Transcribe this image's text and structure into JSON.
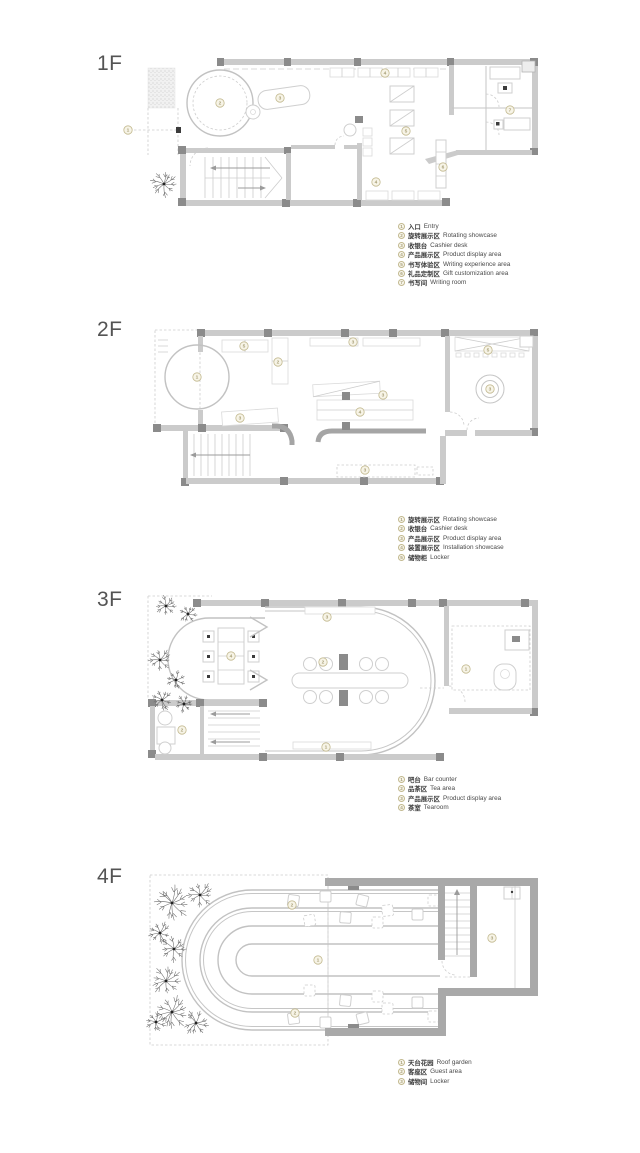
{
  "colors": {
    "wall": "#cbcbcb",
    "wall_dark": "#a9a9a9",
    "column": "#8b8b8b",
    "marker_ring": "#c2b98f",
    "marker_fill": "#f8f6ec",
    "marker_text": "#a89f77",
    "floor_label": "#545454",
    "legend_text": "#3e3e3e"
  },
  "floors": [
    {
      "id": "f1",
      "label": "1F",
      "legend": [
        {
          "num": "1",
          "zh": "入口",
          "en": "Entry"
        },
        {
          "num": "2",
          "zh": "旋转展示区",
          "en": "Rotating showcase"
        },
        {
          "num": "3",
          "zh": "收银台",
          "en": "Cashier desk"
        },
        {
          "num": "4",
          "zh": "产品展示区",
          "en": "Product display area"
        },
        {
          "num": "5",
          "zh": "书写体验区",
          "en": "Writing experience area"
        },
        {
          "num": "6",
          "zh": "礼品定制区",
          "en": "Gift customization area"
        },
        {
          "num": "7",
          "zh": "书写间",
          "en": "Writing room"
        }
      ],
      "plan_markers": [
        {
          "num": "1",
          "x": 8,
          "y": 80
        },
        {
          "num": "2",
          "x": 100,
          "y": 53
        },
        {
          "num": "3",
          "x": 160,
          "y": 48
        },
        {
          "num": "4",
          "x": 265,
          "y": 23
        },
        {
          "num": "5",
          "x": 286,
          "y": 81
        },
        {
          "num": "6",
          "x": 323,
          "y": 117
        },
        {
          "num": "4",
          "x": 256,
          "y": 132
        },
        {
          "num": "7",
          "x": 390,
          "y": 60
        }
      ]
    },
    {
      "id": "f2",
      "label": "2F",
      "legend": [
        {
          "num": "1",
          "zh": "旋转展示区",
          "en": "Rotating showcase"
        },
        {
          "num": "2",
          "zh": "收银台",
          "en": "Cashier desk"
        },
        {
          "num": "3",
          "zh": "产品展示区",
          "en": "Product display area"
        },
        {
          "num": "4",
          "zh": "装置展示区",
          "en": "Installation showcase"
        },
        {
          "num": "5",
          "zh": "储物柜",
          "en": "Locker"
        }
      ],
      "plan_markers": [
        {
          "num": "1",
          "x": 77,
          "y": 57
        },
        {
          "num": "5",
          "x": 124,
          "y": 26
        },
        {
          "num": "2",
          "x": 158,
          "y": 42
        },
        {
          "num": "3",
          "x": 233,
          "y": 22
        },
        {
          "num": "3",
          "x": 263,
          "y": 75
        },
        {
          "num": "4",
          "x": 240,
          "y": 92
        },
        {
          "num": "3",
          "x": 120,
          "y": 98
        },
        {
          "num": "3",
          "x": 245,
          "y": 150
        },
        {
          "num": "5",
          "x": 368,
          "y": 30
        },
        {
          "num": "3",
          "x": 370,
          "y": 69
        }
      ]
    },
    {
      "id": "f3",
      "label": "3F",
      "legend": [
        {
          "num": "1",
          "zh": "吧台",
          "en": "Bar counter"
        },
        {
          "num": "2",
          "zh": "品茶区",
          "en": "Tea area"
        },
        {
          "num": "3",
          "zh": "产品展示区",
          "en": "Product display area"
        },
        {
          "num": "4",
          "zh": "茶室",
          "en": "Tearoom"
        }
      ],
      "plan_markers": [
        {
          "num": "4",
          "x": 111,
          "y": 66
        },
        {
          "num": "3",
          "x": 207,
          "y": 27
        },
        {
          "num": "2",
          "x": 203,
          "y": 72
        },
        {
          "num": "2",
          "x": 62,
          "y": 140
        },
        {
          "num": "1",
          "x": 206,
          "y": 157
        },
        {
          "num": "1",
          "x": 346,
          "y": 79
        }
      ]
    },
    {
      "id": "f4",
      "label": "4F",
      "legend": [
        {
          "num": "1",
          "zh": "天台花园",
          "en": "Roof garden"
        },
        {
          "num": "2",
          "zh": "客座区",
          "en": "Guest area"
        },
        {
          "num": "3",
          "zh": "储物间",
          "en": "Locker"
        }
      ],
      "plan_markers": [
        {
          "num": "2",
          "x": 172,
          "y": 40
        },
        {
          "num": "1",
          "x": 198,
          "y": 95
        },
        {
          "num": "2",
          "x": 175,
          "y": 148
        },
        {
          "num": "3",
          "x": 372,
          "y": 73
        }
      ]
    }
  ]
}
